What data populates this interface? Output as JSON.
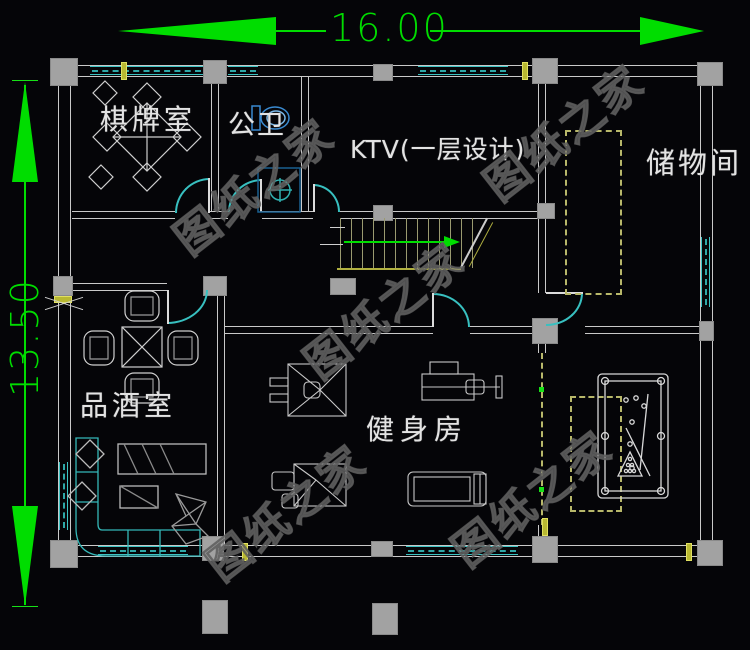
{
  "plan": {
    "dimensions": {
      "width_label": "16.00",
      "height_label": "13.50"
    },
    "rooms": {
      "chess": "棋牌室",
      "bath": "公卫",
      "ktv": "KTV(一层设计)",
      "storage": "储物间",
      "wine": "品酒室",
      "gym": "健身房"
    },
    "watermark": "图纸之家",
    "colors": {
      "background": "#050508",
      "wall": "#c9c9c9",
      "column": "#a2a2a2",
      "window": "#3cc3c3",
      "door": "#38c0c0",
      "dimension_green": "#00dd00",
      "stair_olive": "#b0b040",
      "dashed_closet": "#b8b86a",
      "fixture_blue": "#3a8ad0",
      "watermark_gray": "#8c8c8c"
    }
  }
}
